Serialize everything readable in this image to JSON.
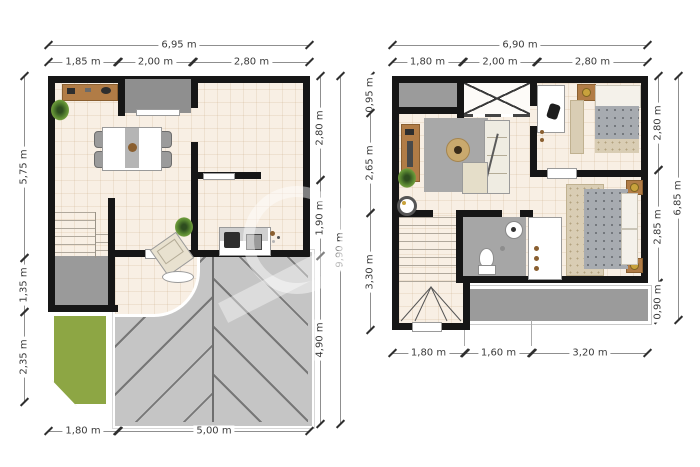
{
  "ground_floor": {
    "dim_total_width": "6,95 m",
    "dim_top_segments": [
      "1,85 m",
      "2,00 m",
      "2,80 m"
    ],
    "dim_left_segments": [
      "5,75 m",
      "1,35 m",
      "2,35 m"
    ],
    "dim_right_segments": [
      "2,80 m",
      "1,90 m",
      "4,90 m"
    ],
    "dim_total_height": "9,90 m",
    "dim_bottom_segments": [
      "1,80 m",
      "5,00 m"
    ]
  },
  "upper_floor": {
    "dim_total_width": "6,90 m",
    "dim_top_segments": [
      "1,80 m",
      "2,00 m",
      "2,80 m"
    ],
    "dim_left_segments": [
      "0,95 m",
      "2,65 m",
      "3,30 m"
    ],
    "dim_right_segments": [
      "2,80 m",
      "2,85 m",
      "0,90 m"
    ],
    "dim_total_height": "6,85 m",
    "dim_bottom_segments": [
      "1,80 m",
      "1,60 m",
      "3,20 m"
    ]
  },
  "colors": {
    "wall": "#161616",
    "floor": "#f8efe4",
    "paving_gray": "#c5c5c5",
    "porch_gray": "#999999",
    "grass_green": "#8da644",
    "wood": "#b17c46",
    "dimension_text": "#3b3b3b"
  }
}
